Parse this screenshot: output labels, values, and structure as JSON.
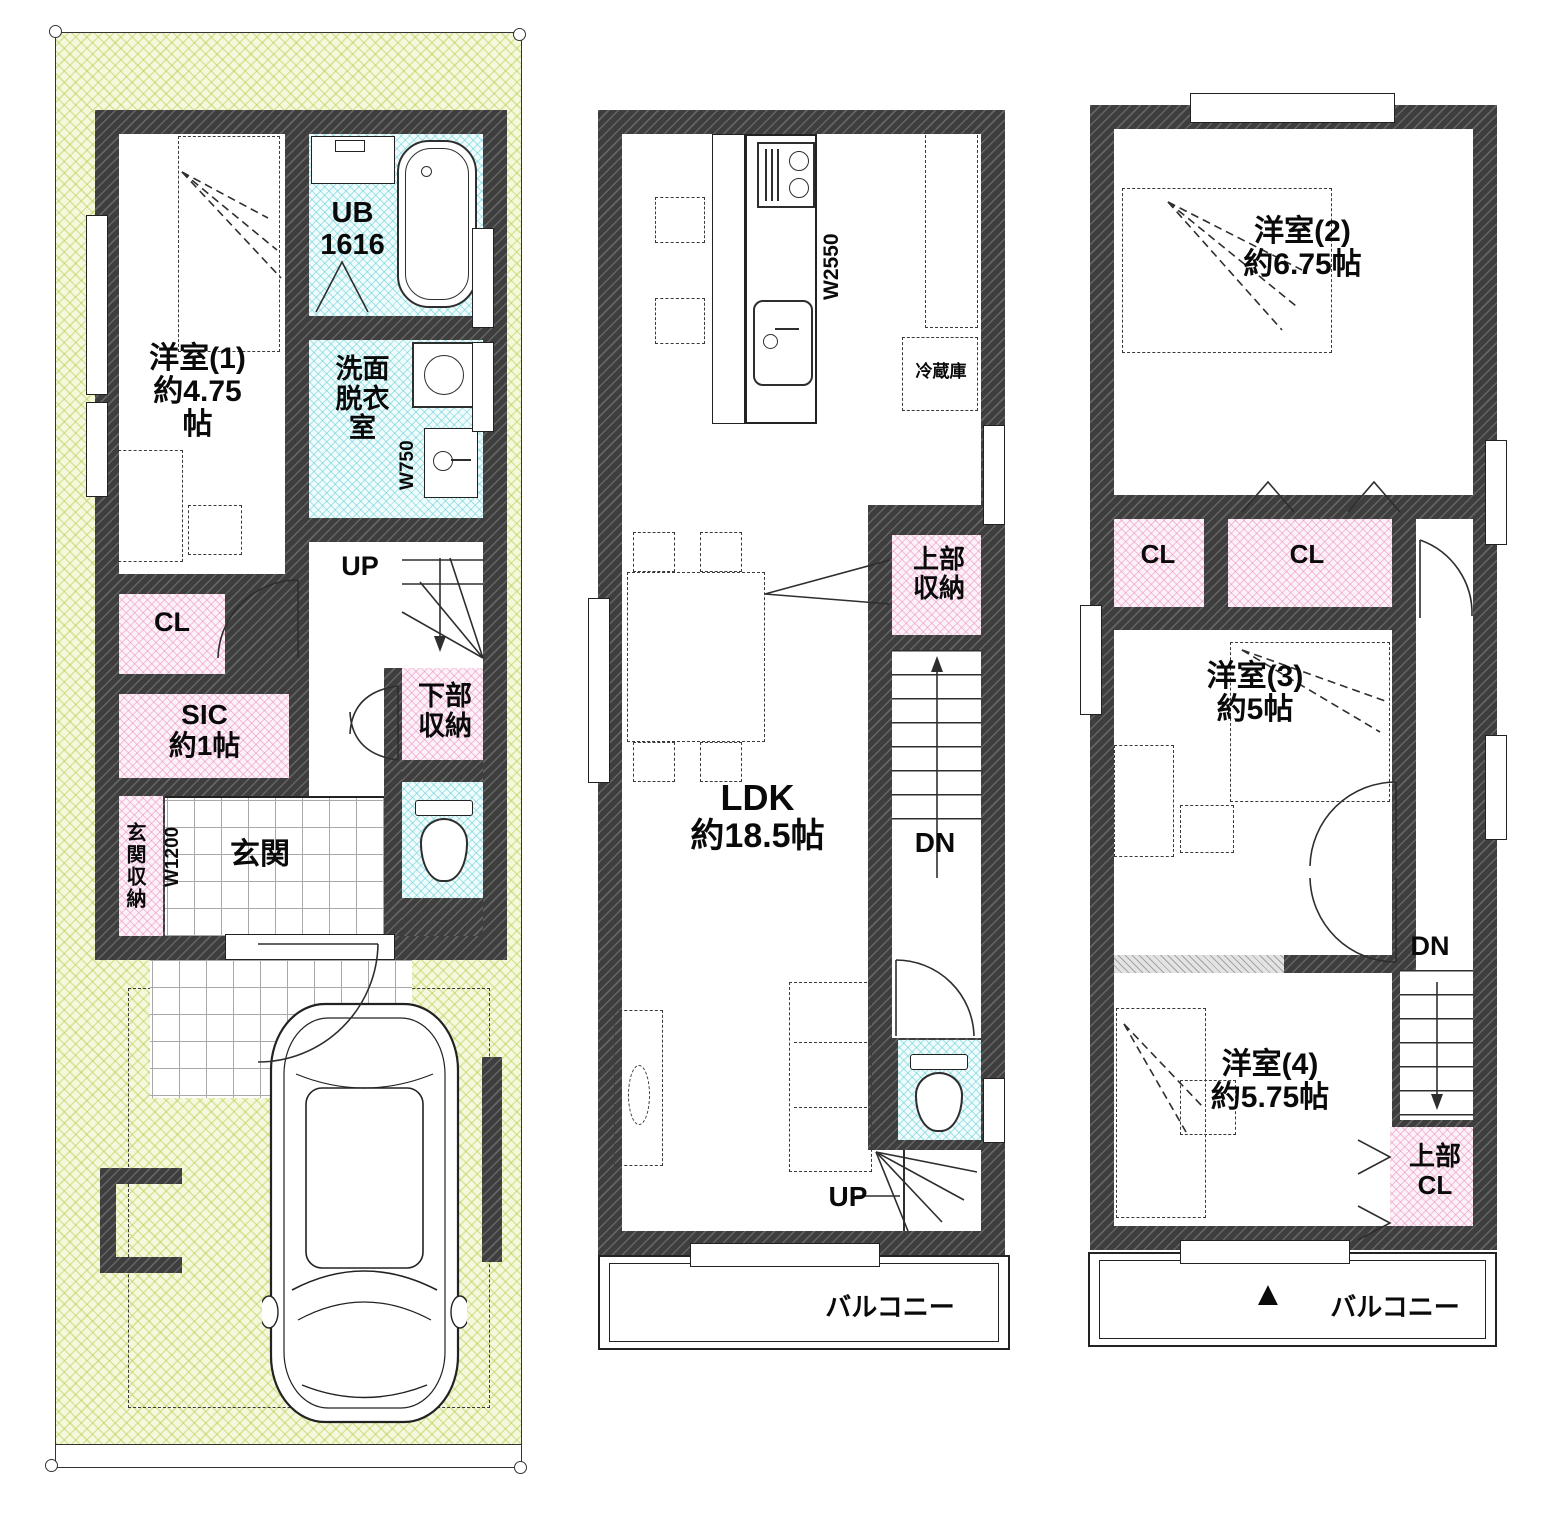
{
  "colors": {
    "plot": "#eef3c8",
    "pink_accent": "#f4c6e0",
    "cyan_accent": "#bfeef2",
    "wall": "#3e3e3e"
  },
  "f1": {
    "room1": {
      "l1": "洋室(1)",
      "l2": "約4.75",
      "l3": "帖"
    },
    "ub": {
      "l1": "UB",
      "l2": "1616"
    },
    "senmen": {
      "l1": "洗面",
      "l2": "脱衣",
      "l3": "室"
    },
    "w750": "W750",
    "up": "UP",
    "cl": "CL",
    "sic": {
      "l1": "SIC",
      "l2": "約1帖"
    },
    "genkan_storage": "玄関収納",
    "w1200": "W1200",
    "genkan": "玄関",
    "shita": {
      "l1": "下部",
      "l2": "収納"
    }
  },
  "f2": {
    "w2550": "W2550",
    "fridge": "冷蔵庫",
    "joubu": {
      "l1": "上部",
      "l2": "収納"
    },
    "ldk": {
      "l1": "LDK",
      "l2": "約18.5帖"
    },
    "dn": "DN",
    "up": "UP",
    "balcony": "バルコニー"
  },
  "f3": {
    "room2": {
      "l1": "洋室(2)",
      "l2": "約6.75帖"
    },
    "cl1": "CL",
    "cl2": "CL",
    "room3": {
      "l1": "洋室(3)",
      "l2": "約5帖"
    },
    "room4": {
      "l1": "洋室(4)",
      "l2": "約5.75帖"
    },
    "dn": "DN",
    "joubu_cl": {
      "l1": "上部",
      "l2": "CL"
    },
    "balcony": "バルコニー",
    "marker": "▲"
  }
}
